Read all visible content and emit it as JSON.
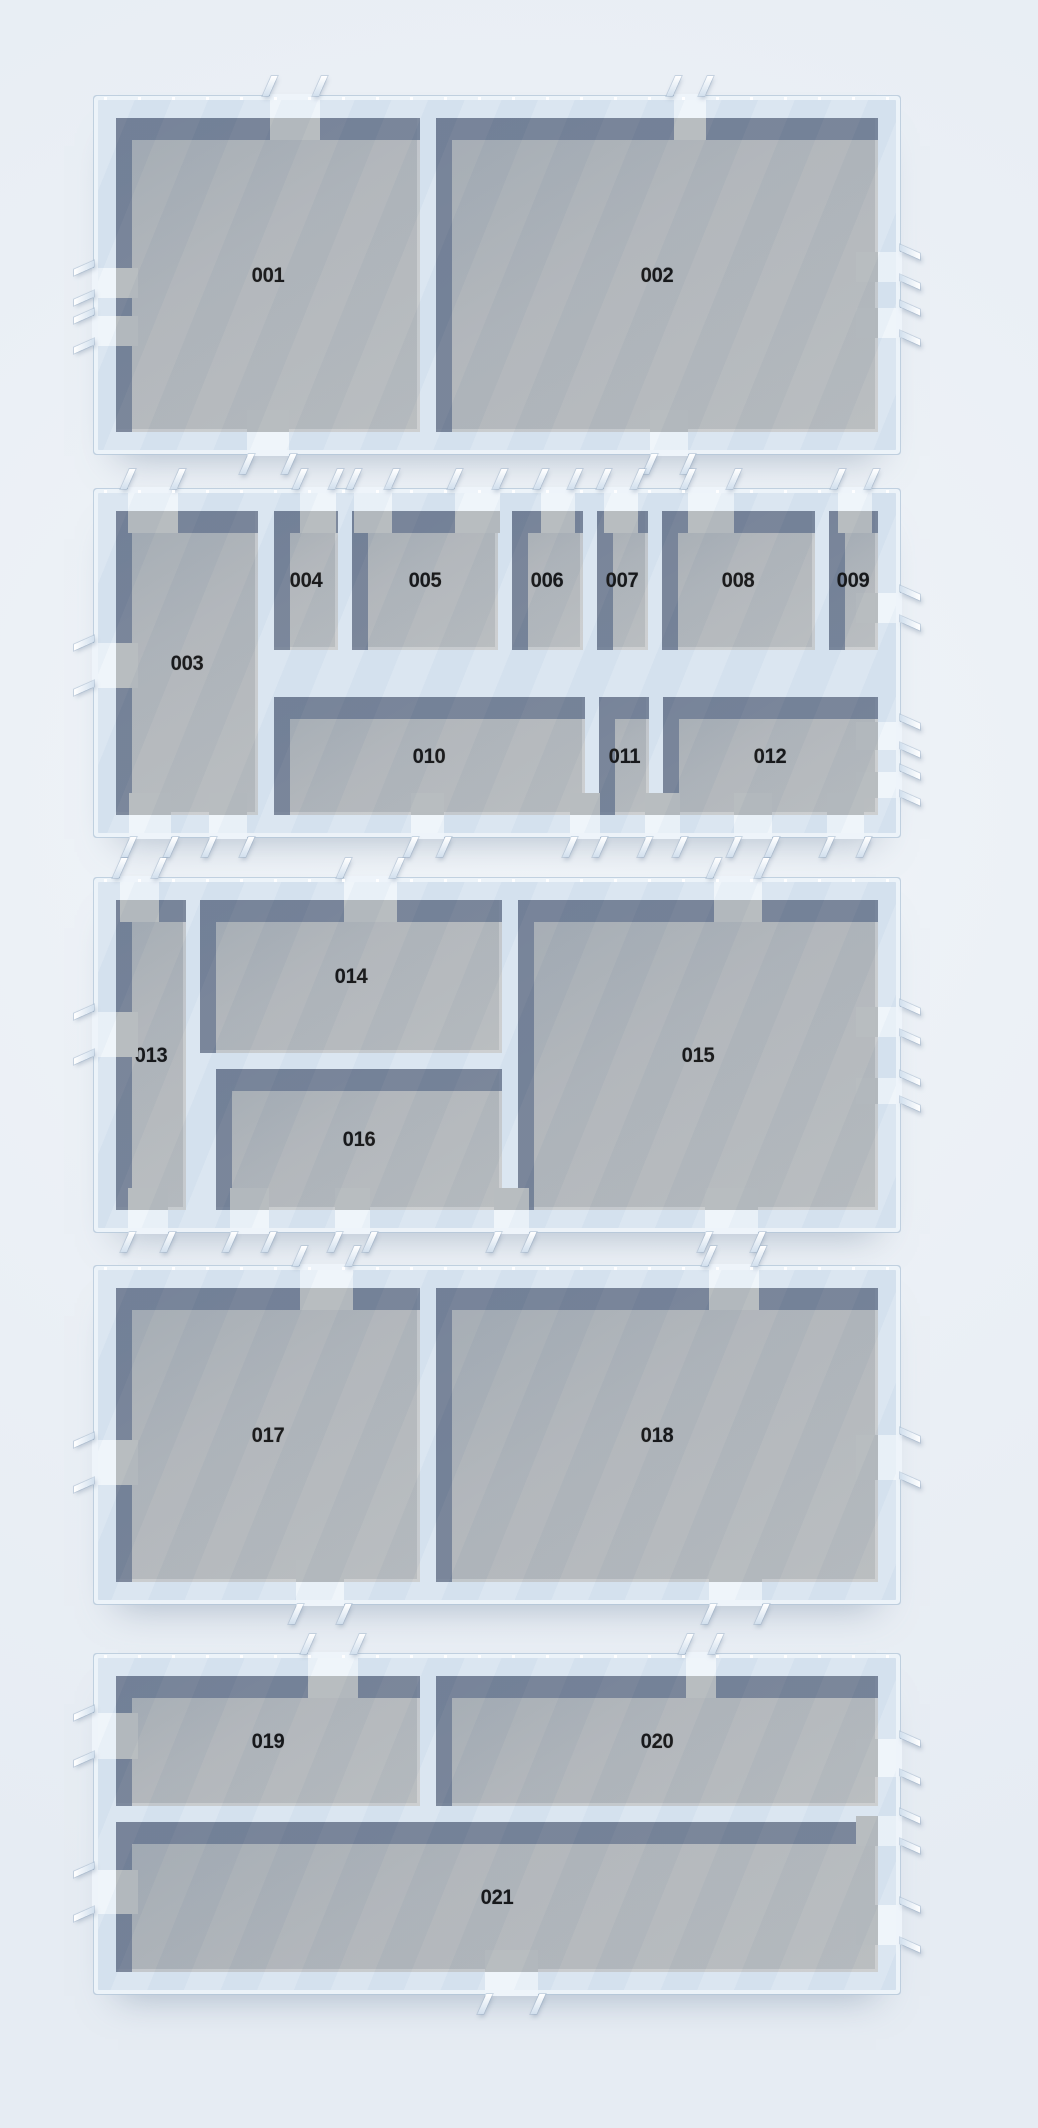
{
  "scene": {
    "type": "floor-plan-3d-render",
    "background_color": "#eaeff5",
    "wall_fill_color": "#d8e4f0",
    "wall_frame_color": "#eef4fa",
    "wall_edge_color": "#b2c5d8",
    "wall_shadow_color": "rgba(99,114,139,0.82)",
    "floor_color": "#b5b9bc",
    "door_color": "#eef4fa",
    "label_color": "#0b0b0c",
    "room_labels": [
      "001",
      "002",
      "003",
      "004",
      "005",
      "006",
      "007",
      "008",
      "009",
      "010",
      "011",
      "012",
      "013",
      "014",
      "015",
      "016",
      "017",
      "018",
      "019",
      "020",
      "021"
    ]
  },
  "buildings": [
    {
      "id": "1",
      "x": 98,
      "y": 100,
      "w": 798,
      "h": 350,
      "rooms": [
        {
          "label": "001",
          "x": 18,
          "y": 18,
          "w": 304,
          "h": 314
        },
        {
          "label": "002",
          "x": 338,
          "y": 18,
          "w": 442,
          "h": 314
        }
      ],
      "doors": [
        {
          "side": "top",
          "pos": 172,
          "len": 50
        },
        {
          "side": "top",
          "pos": 576,
          "len": 32
        },
        {
          "side": "bottom",
          "pos": 149,
          "len": 42
        },
        {
          "side": "bottom",
          "pos": 552,
          "len": 38
        },
        {
          "side": "left",
          "pos": 168,
          "len": 30
        },
        {
          "side": "left",
          "pos": 216,
          "len": 30
        },
        {
          "side": "right",
          "pos": 152,
          "len": 30
        },
        {
          "side": "right",
          "pos": 208,
          "len": 30
        }
      ]
    },
    {
      "id": "2",
      "x": 98,
      "y": 493,
      "w": 798,
      "h": 340,
      "rooms": [
        {
          "label": "003",
          "x": 18,
          "y": 18,
          "w": 142,
          "h": 304
        },
        {
          "label": "004",
          "x": 176,
          "y": 18,
          "w": 64,
          "h": 139
        },
        {
          "label": "005",
          "x": 254,
          "y": 18,
          "w": 146,
          "h": 139
        },
        {
          "label": "006",
          "x": 414,
          "y": 18,
          "w": 71,
          "h": 139
        },
        {
          "label": "007",
          "x": 499,
          "y": 18,
          "w": 51,
          "h": 139
        },
        {
          "label": "008",
          "x": 564,
          "y": 18,
          "w": 153,
          "h": 139
        },
        {
          "label": "009",
          "x": 731,
          "y": 18,
          "w": 49,
          "h": 139
        },
        {
          "label": "010",
          "x": 176,
          "y": 204,
          "w": 311,
          "h": 118
        },
        {
          "label": "011",
          "x": 501,
          "y": 204,
          "w": 50,
          "h": 118
        },
        {
          "label": "012",
          "x": 565,
          "y": 204,
          "w": 215,
          "h": 118
        }
      ],
      "doors": [
        {
          "side": "top",
          "pos": 30,
          "len": 50
        },
        {
          "side": "top",
          "pos": 202,
          "len": 36
        },
        {
          "side": "top",
          "pos": 256,
          "len": 38
        },
        {
          "side": "top",
          "pos": 357,
          "len": 45
        },
        {
          "side": "top",
          "pos": 443,
          "len": 34
        },
        {
          "side": "top",
          "pos": 506,
          "len": 34
        },
        {
          "side": "top",
          "pos": 590,
          "len": 46
        },
        {
          "side": "top",
          "pos": 740,
          "len": 34
        },
        {
          "side": "bottom",
          "pos": 31,
          "len": 42
        },
        {
          "side": "bottom",
          "pos": 111,
          "len": 38
        },
        {
          "side": "bottom",
          "pos": 313,
          "len": 33
        },
        {
          "side": "bottom",
          "pos": 472,
          "len": 30
        },
        {
          "side": "bottom",
          "pos": 547,
          "len": 35
        },
        {
          "side": "bottom",
          "pos": 636,
          "len": 38
        },
        {
          "side": "bottom",
          "pos": 729,
          "len": 37
        },
        {
          "side": "left",
          "pos": 150,
          "len": 45
        },
        {
          "side": "right",
          "pos": 100,
          "len": 30
        },
        {
          "side": "right",
          "pos": 229,
          "len": 28
        },
        {
          "side": "right",
          "pos": 279,
          "len": 26
        }
      ]
    },
    {
      "id": "3",
      "x": 98,
      "y": 882,
      "w": 798,
      "h": 346,
      "rooms": [
        {
          "label": "013",
          "x": 18,
          "y": 18,
          "w": 70,
          "h": 310
        },
        {
          "label": "014",
          "x": 102,
          "y": 18,
          "w": 302,
          "h": 153
        },
        {
          "label": "015",
          "x": 420,
          "y": 18,
          "w": 360,
          "h": 310
        },
        {
          "label": "016",
          "x": 118,
          "y": 187,
          "w": 286,
          "h": 141
        }
      ],
      "doors": [
        {
          "side": "top",
          "pos": 22,
          "len": 39
        },
        {
          "side": "top",
          "pos": 246,
          "len": 53
        },
        {
          "side": "top",
          "pos": 616,
          "len": 48
        },
        {
          "side": "bottom",
          "pos": 30,
          "len": 40
        },
        {
          "side": "bottom",
          "pos": 132,
          "len": 39
        },
        {
          "side": "bottom",
          "pos": 237,
          "len": 35
        },
        {
          "side": "bottom",
          "pos": 396,
          "len": 35
        },
        {
          "side": "bottom",
          "pos": 607,
          "len": 53
        },
        {
          "side": "left",
          "pos": 130,
          "len": 45
        },
        {
          "side": "right",
          "pos": 125,
          "len": 30
        },
        {
          "side": "right",
          "pos": 196,
          "len": 26
        }
      ]
    },
    {
      "id": "4",
      "x": 98,
      "y": 1270,
      "w": 798,
      "h": 330,
      "rooms": [
        {
          "label": "017",
          "x": 18,
          "y": 18,
          "w": 304,
          "h": 294
        },
        {
          "label": "018",
          "x": 338,
          "y": 18,
          "w": 442,
          "h": 294
        }
      ],
      "doors": [
        {
          "side": "top",
          "pos": 202,
          "len": 53
        },
        {
          "side": "top",
          "pos": 611,
          "len": 50
        },
        {
          "side": "bottom",
          "pos": 198,
          "len": 48
        },
        {
          "side": "bottom",
          "pos": 611,
          "len": 53
        },
        {
          "side": "left",
          "pos": 170,
          "len": 45
        },
        {
          "side": "right",
          "pos": 165,
          "len": 45
        }
      ]
    },
    {
      "id": "5",
      "x": 98,
      "y": 1658,
      "w": 798,
      "h": 332,
      "rooms": [
        {
          "label": "019",
          "x": 18,
          "y": 18,
          "w": 304,
          "h": 130
        },
        {
          "label": "020",
          "x": 338,
          "y": 18,
          "w": 442,
          "h": 130
        },
        {
          "label": "021",
          "x": 18,
          "y": 164,
          "w": 762,
          "h": 150
        }
      ],
      "doors": [
        {
          "side": "top",
          "pos": 210,
          "len": 50
        },
        {
          "side": "top",
          "pos": 588,
          "len": 30
        },
        {
          "side": "bottom",
          "pos": 387,
          "len": 53
        },
        {
          "side": "left",
          "pos": 55,
          "len": 46
        },
        {
          "side": "left",
          "pos": 212,
          "len": 44
        },
        {
          "side": "right",
          "pos": 81,
          "len": 38
        },
        {
          "side": "right",
          "pos": 158,
          "len": 30
        },
        {
          "side": "right",
          "pos": 247,
          "len": 40
        }
      ]
    }
  ]
}
